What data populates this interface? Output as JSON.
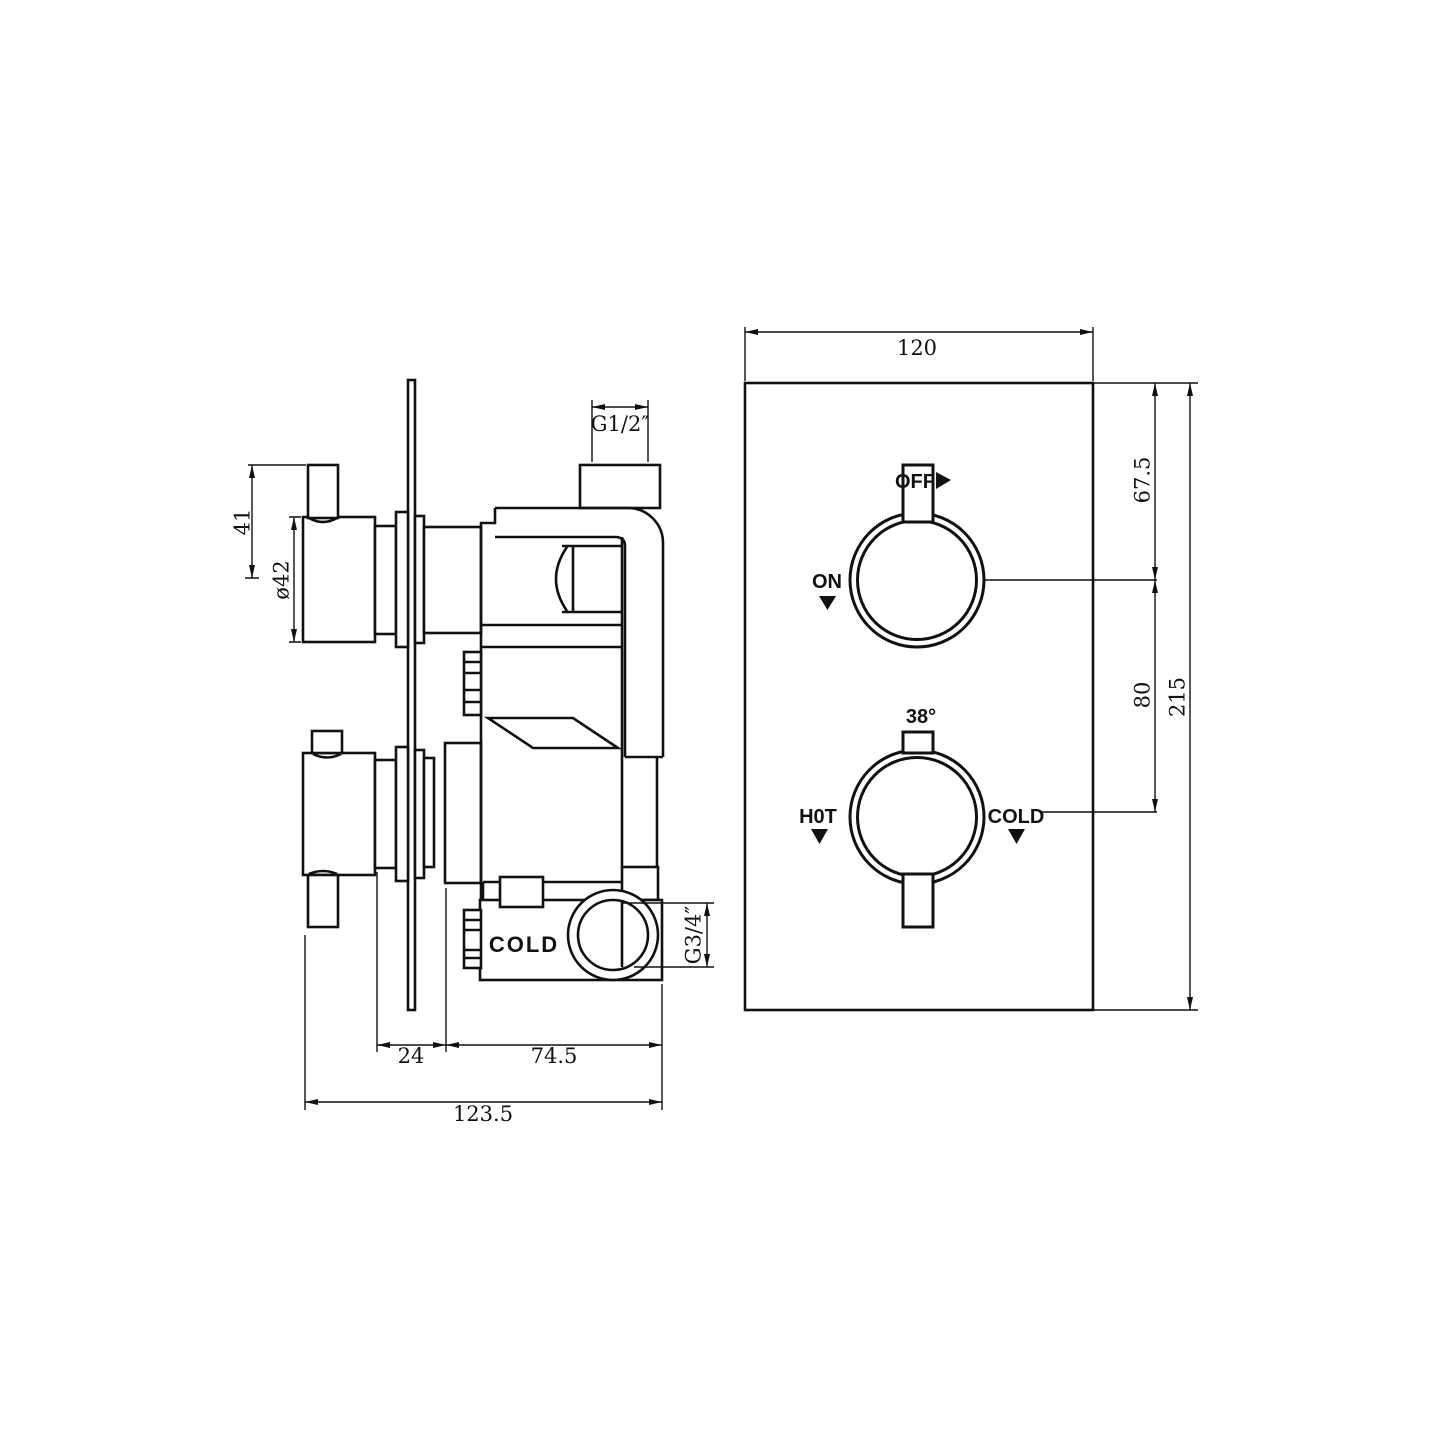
{
  "drawing": {
    "side_view": {
      "port_label": "COLD",
      "dims": {
        "lever": "41",
        "knob_dia": "ø42",
        "outlet_thread": "G1/2″",
        "inlet_thread": "G3/4″",
        "knob_depth": "24",
        "body_depth": "74.5",
        "overall_depth": "123.5"
      }
    },
    "front_view": {
      "labels": {
        "off": "OFF",
        "on": "ON",
        "temp": "38°",
        "hot": "H0T",
        "cold": "COLD"
      },
      "dims": {
        "width": "120",
        "top_to_first_knob": "67.5",
        "knob_spacing": "80",
        "height": "215"
      }
    },
    "colors": {
      "line": "#111111",
      "background": "#ffffff"
    }
  }
}
